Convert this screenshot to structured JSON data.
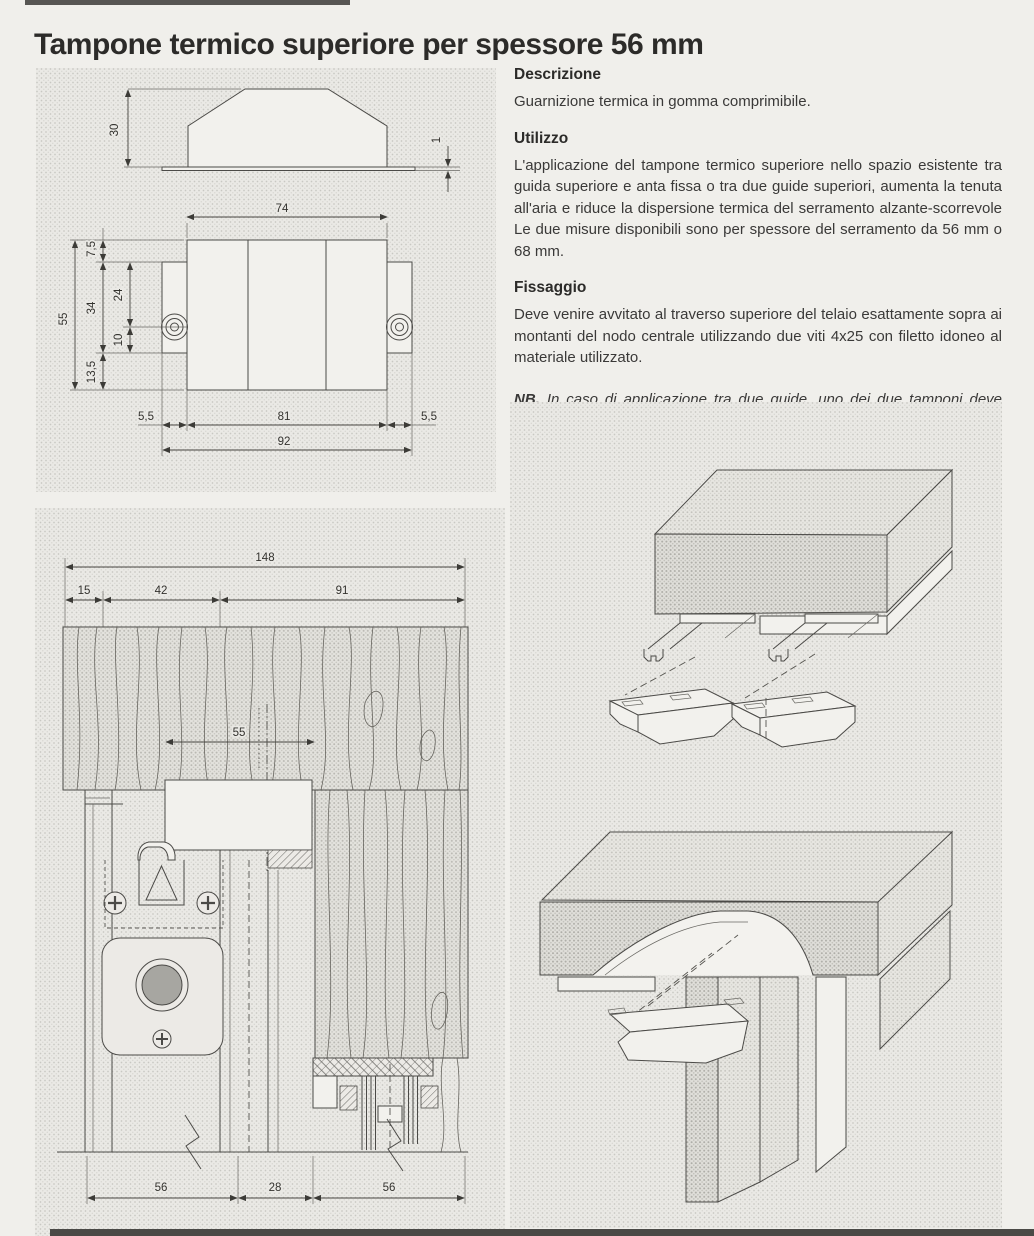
{
  "title": "Tampone termico superiore per spessore 56 mm",
  "sections": [
    {
      "heading": "Descrizione",
      "body": "Guarnizione termica in gomma comprimibile."
    },
    {
      "heading": "Utilizzo",
      "body": "L'applicazione del tampone termico superiore nello spazio esistente tra guida superiore e anta fissa o tra due guide superiori, aumenta la tenuta all'aria e riduce la dispersione termica del serramento alzante-scorrevole Le due misure disponibili sono per spessore del serramento da 56 mm o 68 mm."
    },
    {
      "heading": "Fissaggio",
      "body": "Deve venire avvitato al traverso superiore del telaio esattamente sopra ai montanti del nodo centrale utilizzando due viti 4x25 con filetto idoneo al materiale utilizzato."
    }
  ],
  "note": {
    "label": "NB.",
    "line1": "In caso di applicazione tra due guide, uno dei due tamponi deve esse-",
    "line2": "re tagliato come in figura sottostante."
  },
  "dimensions": {
    "side_view": {
      "height": "30",
      "flange": "1"
    },
    "plan_view": {
      "top_width": "74",
      "overall_height": "55",
      "top_offset": "7,5",
      "tab_height": "34",
      "screw_offset": "24",
      "screw_to_tab": "10",
      "bottom_offset": "13,5",
      "left_tab": "5,5",
      "body_width": "81",
      "right_tab": "5,5",
      "overall_width": "92"
    },
    "section_view": {
      "overall": "148",
      "left": "15",
      "mid": "42",
      "right": "91",
      "pad_width": "55",
      "bottom_left": "56",
      "bottom_mid": "28",
      "bottom_right": "56"
    }
  },
  "colors": {
    "page_bg": "#f0efeb",
    "panel_base": "#eae9e5",
    "halftone_dot": "#c9c8c3",
    "line": "#4b4a47",
    "text": "#3a3938",
    "title": "#2c2b29",
    "white_fill": "#f2f1ed",
    "roller_fill": "#a7a6a1",
    "scan_bar": "#3c3b38"
  }
}
